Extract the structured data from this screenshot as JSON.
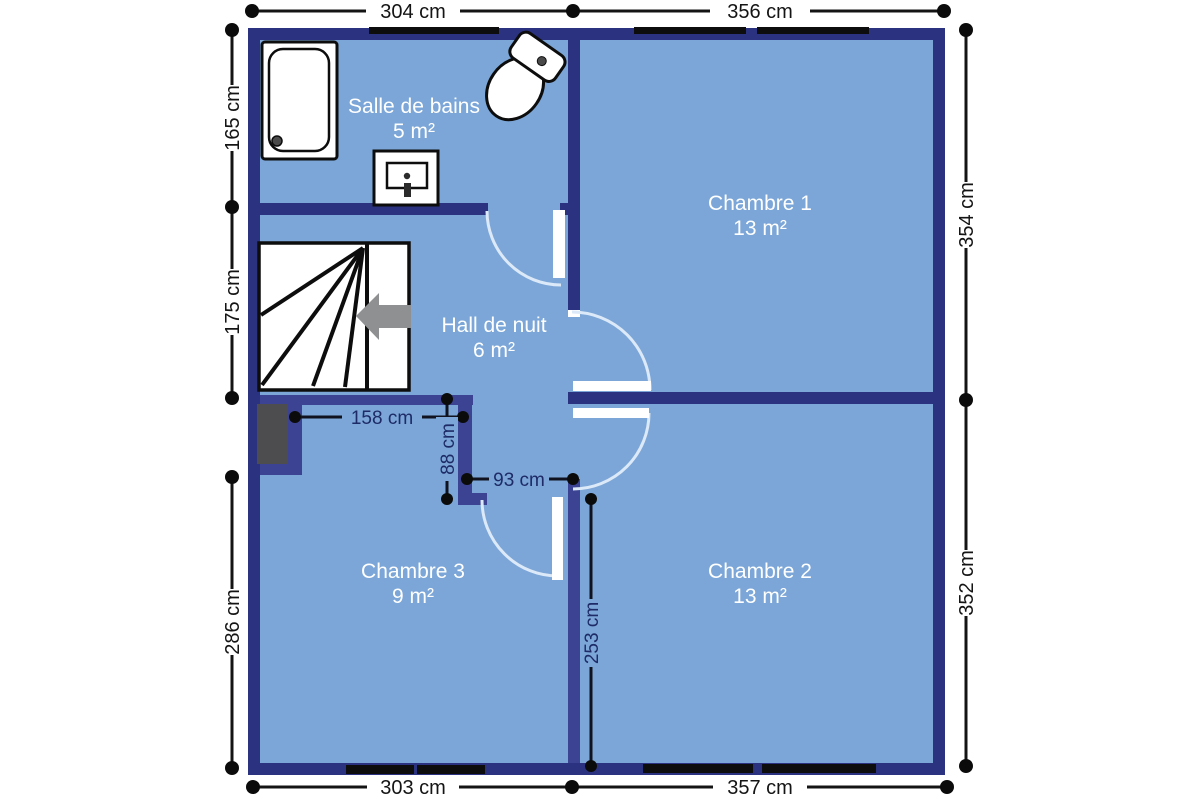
{
  "plan": {
    "rooms": [
      {
        "name": "Salle de bains",
        "area": "5 m²"
      },
      {
        "name": "Chambre 1",
        "area": "13 m²"
      },
      {
        "name": "Hall de nuit",
        "area": "6 m²"
      },
      {
        "name": "Chambre 3",
        "area": "9 m²"
      },
      {
        "name": "Chambre 2",
        "area": "13 m²"
      }
    ],
    "dims": {
      "top": [
        "304 cm",
        "356 cm"
      ],
      "bottom": [
        "303 cm",
        "357 cm"
      ],
      "left": [
        "165 cm",
        "175 cm",
        "286 cm"
      ],
      "right": [
        "354 cm",
        "352 cm"
      ],
      "interior": [
        "158 cm",
        "88 cm",
        "93 cm",
        "253 cm"
      ]
    },
    "fixtures": [
      "shower-tray",
      "toilet",
      "sink",
      "staircase",
      "stairs-direction-arrow",
      "chimney-block"
    ],
    "colors": {
      "room_fill": "#7ba6d7",
      "wall_dark": "#2b3380",
      "wall_light": "#3c4392",
      "window_bar": "#0d0d0d",
      "door_arc": "#dce9f8",
      "dim_text_exterior": "#141414",
      "dim_text_interior": "#1e2b66",
      "room_label": "#ffffff",
      "arrow": "#8e9092",
      "chimney": "#4d4d4f"
    }
  }
}
